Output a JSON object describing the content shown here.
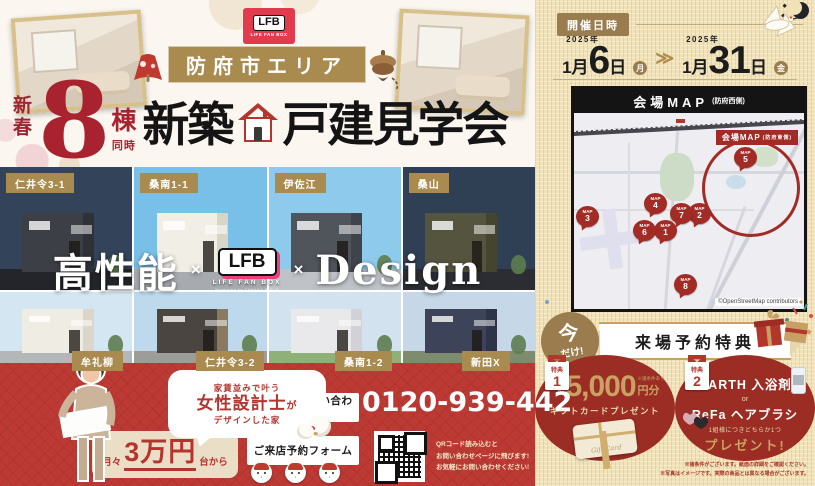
{
  "header": {
    "lfb_badge": {
      "logo": "LFB",
      "sub": "LIFE FAN BOX"
    },
    "area_banner": "防府市エリア",
    "season": "新春",
    "count": "8",
    "count_unit": "棟",
    "count_unit2": "同時",
    "title_a": "新築",
    "title_b": "戸建見学会"
  },
  "houses": {
    "row1": [
      {
        "label": "仁井令3-1",
        "sky": "#33435a",
        "wall": "#3c3f45",
        "side": "#2e3136",
        "ground": "#23252b"
      },
      {
        "label": "桑南1-1",
        "sky": "#79c0e8",
        "wall": "#f1eee6",
        "side": "#d9d4c8",
        "ground": "#a7abb0"
      },
      {
        "label": "伊佐江",
        "sky": "#8ecaec",
        "wall": "#50545b",
        "side": "#3f434a",
        "ground": "#bfc3c8"
      },
      {
        "label": "桑山",
        "sky": "#2f3f54",
        "wall": "#54543f",
        "side": "#44442f",
        "ground": "#2b2d33"
      }
    ],
    "row2": [
      {
        "label": "牟礼柳",
        "sky": "#d4e6f2",
        "wall": "#efece4",
        "side": "#dcd6ca",
        "ground": "#b4b6ba"
      },
      {
        "label": "仁井令3-2",
        "sky": "#bdd9eb",
        "wall": "#4a4540",
        "side": "#8a7a5f",
        "ground": "#9e9c98"
      },
      {
        "label": "桑南1-2",
        "sky": "#d2e2ef",
        "wall": "#e9e9eb",
        "side": "#d2d2d6",
        "ground": "#8fb077"
      },
      {
        "label": "新田X",
        "sky": "#c6d8e7",
        "wall": "#3d4459",
        "side": "#2f3549",
        "ground": "#7e8b6e"
      }
    ]
  },
  "tagline": {
    "left": "高性能",
    "times1": "×",
    "logo": "LFB",
    "logo_sub": "LIFE FAN BOX",
    "logo_caption": "Produced by TANAKA BUILD",
    "times2": "×",
    "right": "Design"
  },
  "contact": {
    "bubble_top": "家賃並みで叶う",
    "bubble_main": "女性設計士",
    "bubble_main_suffix": "が",
    "bubble_bottom": "デザインした家",
    "price_prefix": "月々",
    "price_value": "3万円",
    "price_suffix": "台から",
    "reserve_button": "ご予約・お問い合わせ",
    "form_button": "ご来店予約フォーム",
    "phone": "0120-939-442",
    "qr_note_line1": "QRコード読み込むと",
    "qr_note_line2": "お問い合わせページに飛びます!",
    "qr_note_line3": "お気軽にお問い合わせください!"
  },
  "event": {
    "schedule_label": "開催日時",
    "start": {
      "year": "2025年",
      "month": "1月",
      "day": "6",
      "day_unit": "日",
      "weekday": "月"
    },
    "arrow": "≫",
    "end": {
      "year": "2025年",
      "month": "1月",
      "day": "31",
      "day_unit": "日",
      "weekday": "金"
    }
  },
  "map": {
    "title": "会場MAP",
    "title_note": "(防府西側)",
    "highlight_label": "会場MAP",
    "highlight_note": "(防府東側)",
    "pin_word": "MAP",
    "pins": [
      "1",
      "2",
      "3",
      "4",
      "5",
      "6",
      "7",
      "8"
    ],
    "attribution": "©OpenStreetMap contributors"
  },
  "benefits": {
    "now_top": "今",
    "now_bottom": "だけ!",
    "title": "来場予約特典",
    "b1": {
      "badge": "特典",
      "num": "1",
      "max": "最大",
      "amount": "5,000",
      "unit": "円分",
      "note": "※諸条件あり",
      "desc": "ギフトカードプレゼント",
      "card_label": "Gift Card"
    },
    "b2": {
      "badge": "特典",
      "num": "2",
      "item1": "BARTH 入浴剤",
      "or": "or",
      "item2": "ReFa ヘアブラシ",
      "note": "1組様につきどちらか1つ",
      "desc": "プレゼント!"
    },
    "fine_print1": "※諸条件がございます。紙面の詳細をご確認ください。",
    "fine_print2": "※写真はイメージです。実際の商品とは異なる場合がございます。"
  }
}
